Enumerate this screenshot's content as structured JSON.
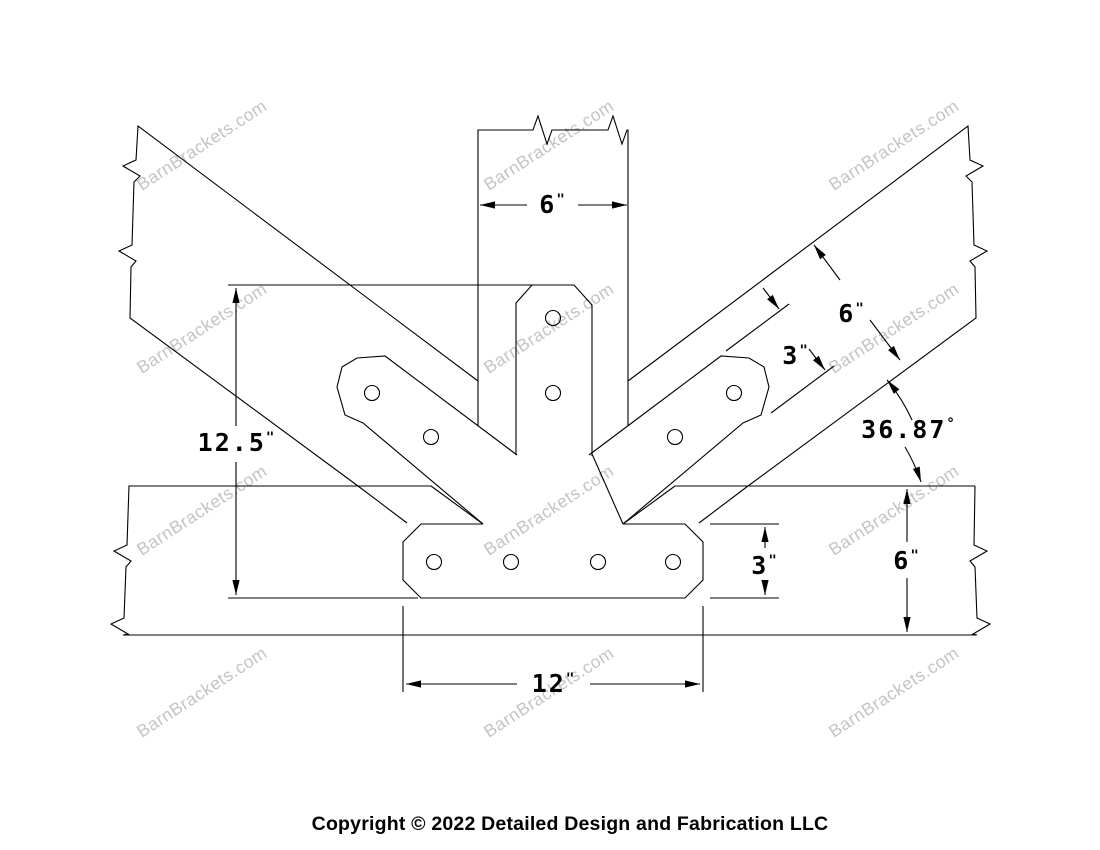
{
  "page": {
    "background_color": "#ffffff",
    "line_color": "#000000"
  },
  "watermark": {
    "text": "BarnBrackets.com",
    "color": "#c4c4c4"
  },
  "footer": {
    "copyright": "Copyright © 2022 Detailed Design and Fabrication LLC"
  },
  "dimensions": {
    "post_width_top": {
      "value": "6",
      "unit": "\""
    },
    "bracket_height_left": {
      "value": "12.5",
      "unit": "\""
    },
    "strut_depth": {
      "value": "6",
      "unit": "\""
    },
    "strut_arm_width": {
      "value": "3",
      "unit": "\""
    },
    "strut_angle": {
      "value": "36.87",
      "unit": "°"
    },
    "chord_depth_right": {
      "value": "6",
      "unit": "\""
    },
    "plate_height": {
      "value": "3",
      "unit": "\""
    },
    "plate_width_bottom": {
      "value": "12",
      "unit": "\""
    }
  }
}
